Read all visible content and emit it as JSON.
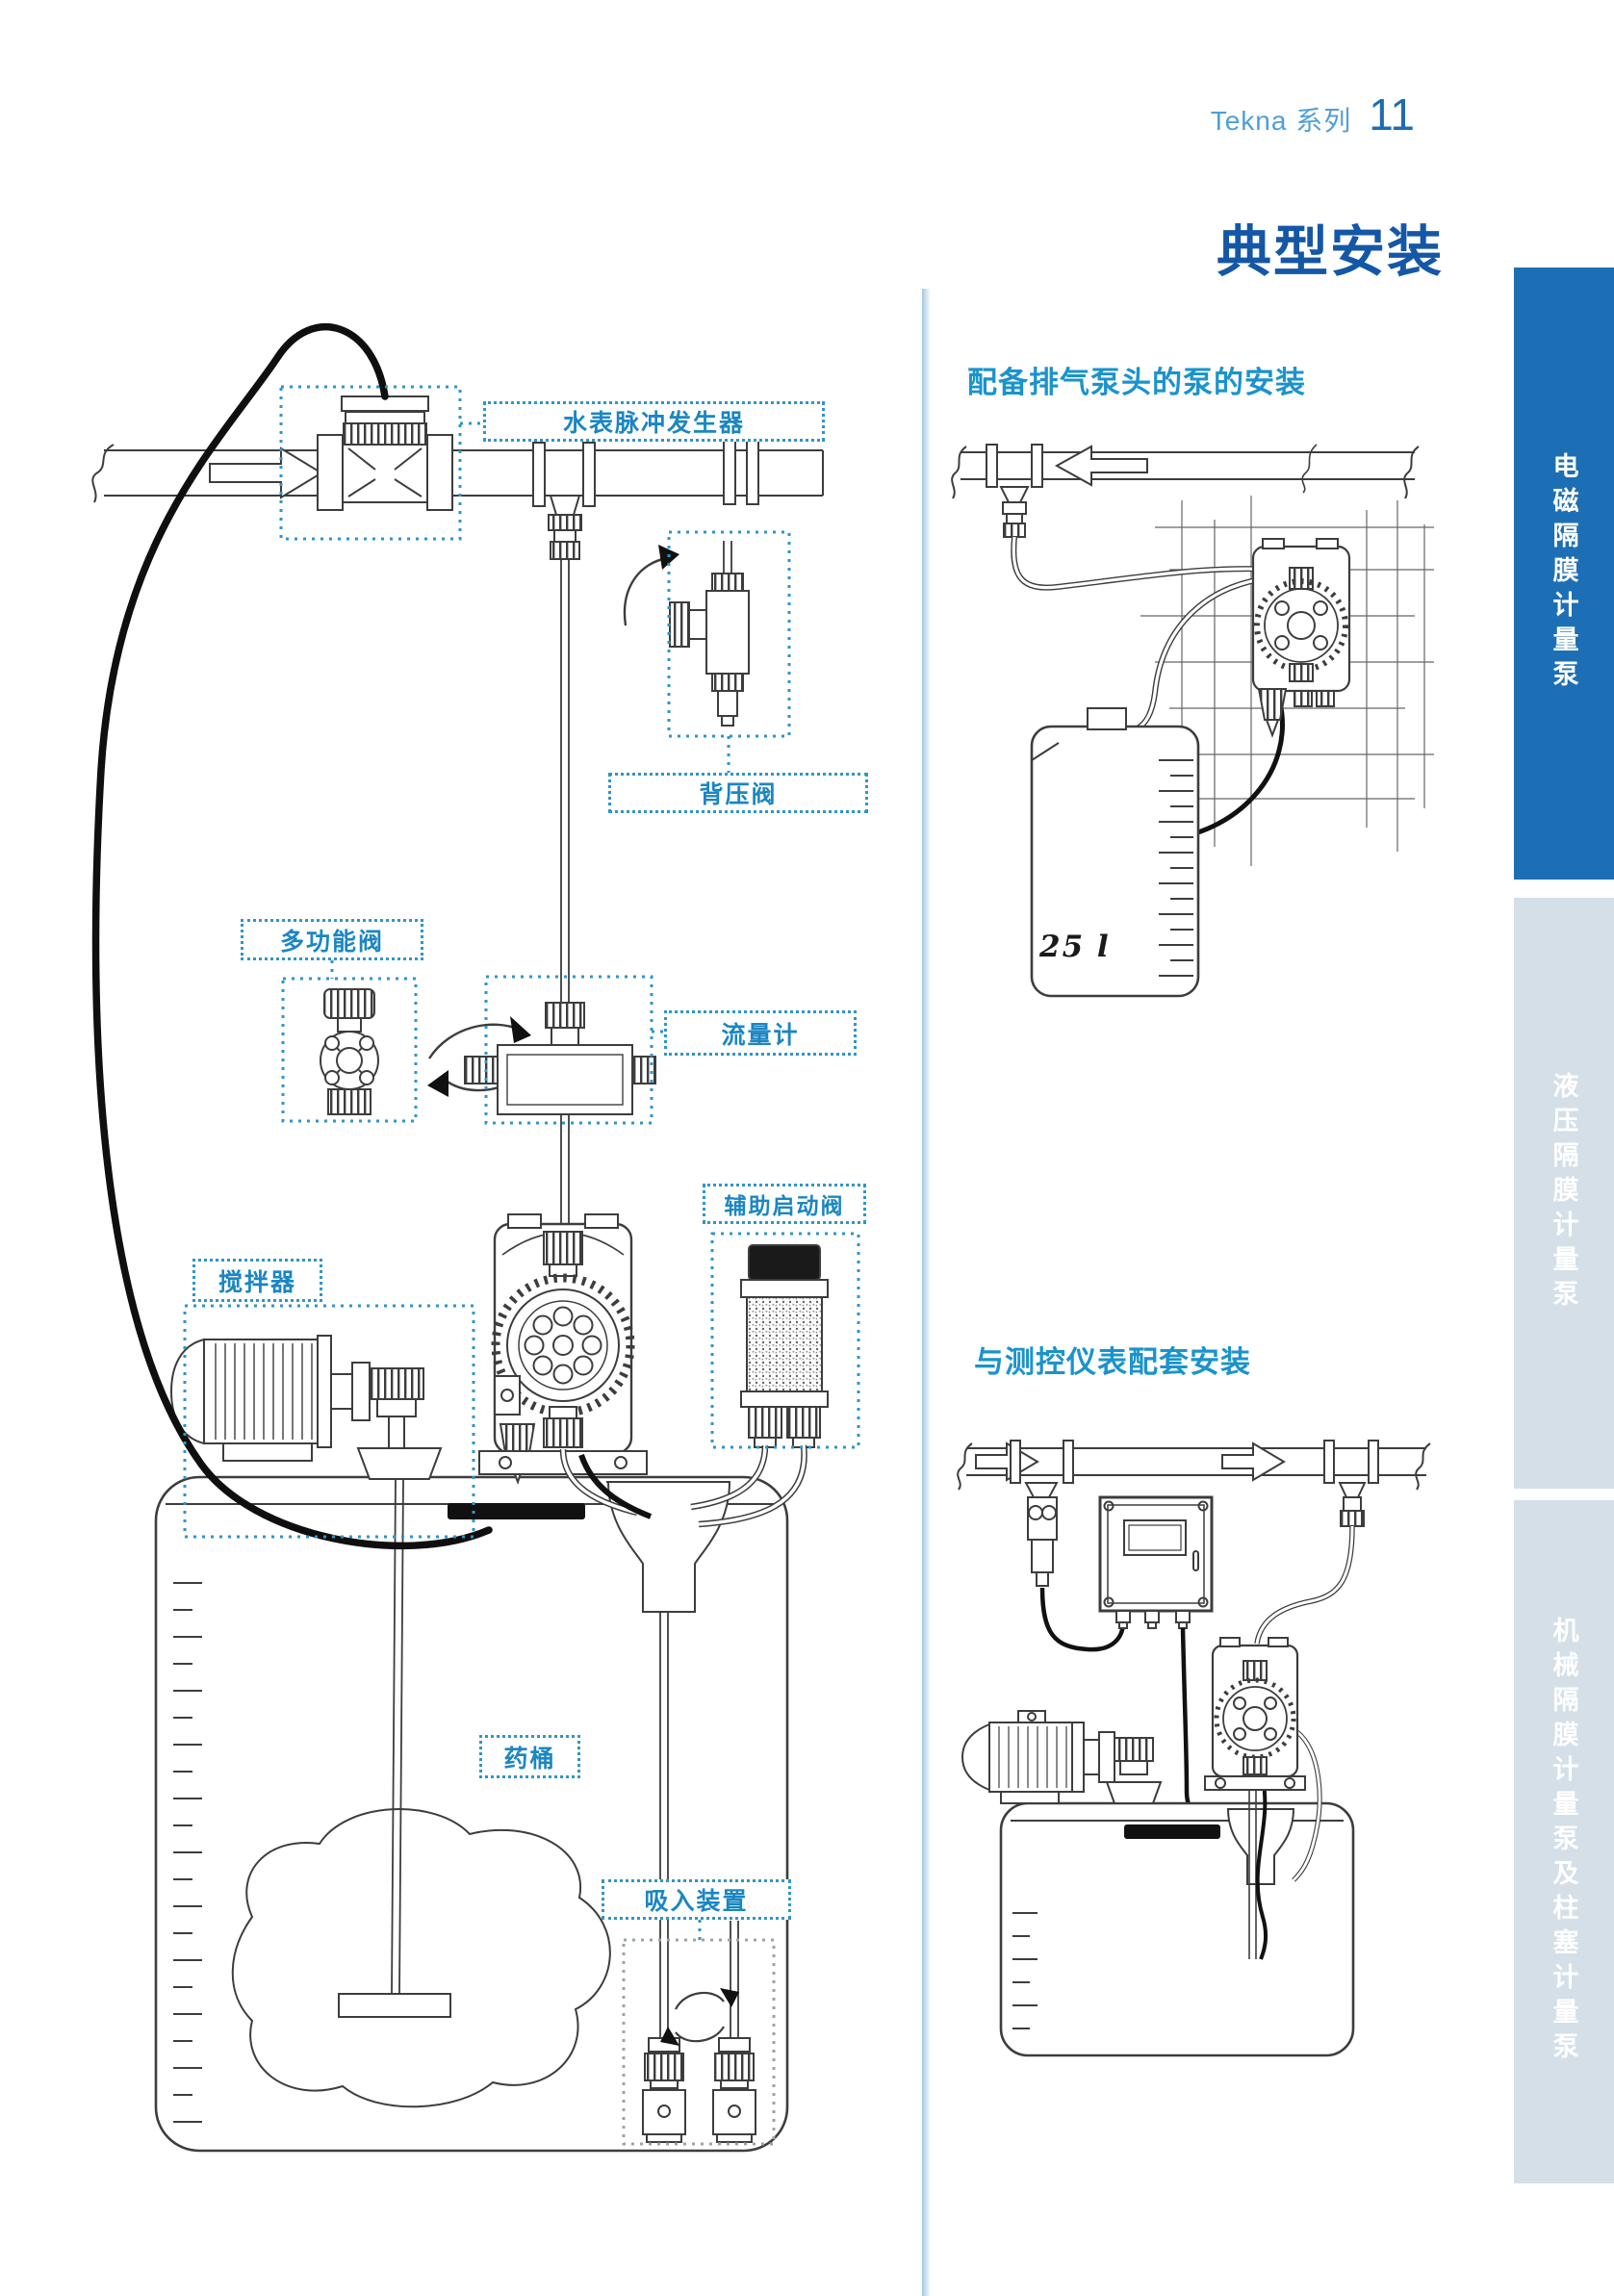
{
  "header": {
    "series": "Tekna 系列",
    "page": "11"
  },
  "title": "典型安装",
  "sidebar": {
    "tabs": [
      {
        "label": "电磁隔膜计量泵",
        "active": true
      },
      {
        "label": "液压隔膜计量泵",
        "active": false
      },
      {
        "label": "机械隔膜计量泵及柱塞计量泵",
        "active": false
      }
    ]
  },
  "diagram": {
    "labels": {
      "water_meter_pulse_generator": "水表脉冲发生器",
      "back_pressure_valve": "背压阀",
      "multifunction_valve": "多功能阀",
      "flow_meter": "流量计",
      "auxiliary_start_valve": "辅助启动阀",
      "mixer": "搅拌器",
      "chemical_tank": "药桶",
      "suction_device": "吸入装置"
    }
  },
  "sections": {
    "degassing": {
      "heading": "配备排气泵头的泵的安装",
      "tank_capacity": "25 l"
    },
    "instruments": {
      "heading": "与测控仪表配套安装"
    }
  },
  "colors": {
    "accent_dark_blue": "#1457a6",
    "accent_cyan": "#1a93cd",
    "label_blue": "#1b86c2",
    "callout_border": "#2e96c8",
    "sidebar_active_blue": "#1d6fb5",
    "sidebar_inactive_gray": "#d5dfe7",
    "line_art": "#3d3d3d",
    "cable_black": "#111111"
  }
}
